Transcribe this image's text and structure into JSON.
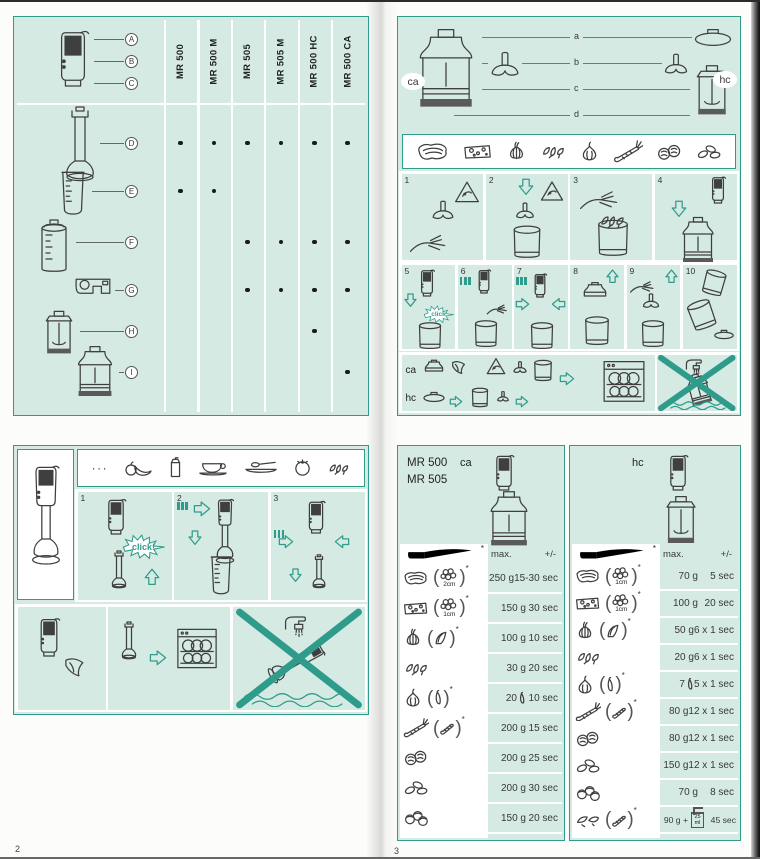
{
  "page": {
    "left_num": "2",
    "right_num": "3"
  },
  "colors": {
    "teal": "#2f9c8b",
    "mint": "#d6eae4",
    "ink": "#383838",
    "paper": "#fcfcfa"
  },
  "compat": {
    "models": [
      "MR 500",
      "MR 500 M",
      "MR 505",
      "MR 505 M",
      "MR 500 HC",
      "MR 500 CA"
    ],
    "head_parts": [
      "A",
      "B",
      "C"
    ],
    "rows": [
      {
        "part": "D",
        "icon": "shaft",
        "dots": [
          true,
          true,
          true,
          true,
          true,
          true
        ]
      },
      {
        "part": "E",
        "icon": "beaker",
        "dots": [
          true,
          true,
          false,
          false,
          false,
          false
        ]
      },
      {
        "part": "F",
        "icon": "cup",
        "dots": [
          false,
          false,
          true,
          true,
          true,
          true
        ]
      },
      {
        "part": "G",
        "icon": "bracket",
        "dots": [
          false,
          false,
          true,
          true,
          true,
          true
        ]
      },
      {
        "part": "H",
        "icon": "chopper-hc",
        "dots": [
          false,
          false,
          false,
          false,
          true,
          false
        ]
      },
      {
        "part": "I",
        "icon": "chopper-ca",
        "dots": [
          false,
          false,
          false,
          false,
          false,
          true
        ]
      }
    ]
  },
  "assembly": {
    "ca": "ca",
    "hc": "hc",
    "letters": [
      "a",
      "b",
      "c",
      "d"
    ],
    "top_steps": [
      "1",
      "2",
      "3",
      "4"
    ],
    "bottom_steps": [
      "5",
      "6",
      "7",
      "8",
      "9",
      "10"
    ],
    "click": "click",
    "foods": [
      "meat",
      "cheese",
      "onion",
      "herbs",
      "garlic",
      "carrot",
      "walnuts",
      "almonds"
    ]
  },
  "usage": {
    "ellipsis": "···",
    "foods": [
      "fruit",
      "carton",
      "cupsaucer",
      "platespoon",
      "tomato",
      "herbs"
    ],
    "steps": [
      "1",
      "2",
      "3"
    ],
    "click": "click!"
  },
  "proc": {
    "model_line1": "MR 500",
    "model_line2": "MR 505",
    "ca": "ca",
    "hc": "hc",
    "max": "max.",
    "tol": "+/-",
    "ast": "*",
    "beaker_l1": "25",
    "beaker_l2": "ml",
    "ca_rows": [
      {
        "food": "meat",
        "prep": "cubes",
        "prep_label": "2cm",
        "amount": "250 g",
        "time": "15-30 sec"
      },
      {
        "food": "cheese",
        "prep": "cubes",
        "prep_label": "1cm",
        "amount": "150 g",
        "time": "30 sec"
      },
      {
        "food": "onion",
        "prep": "quarter",
        "amount": "100 g",
        "time": "10 sec"
      },
      {
        "food": "herbs",
        "amount": "30 g",
        "time": "20 sec"
      },
      {
        "food": "garlic",
        "prep": "clove",
        "amount": "20",
        "amount_icon": "clove",
        "time": "10 sec"
      },
      {
        "food": "carrot",
        "prep": "carrot-cut",
        "amount": "200 g",
        "time": "15 sec"
      },
      {
        "food": "walnuts",
        "amount": "200 g",
        "time": "25 sec"
      },
      {
        "food": "almonds",
        "amount": "200 g",
        "time": "30 sec"
      },
      {
        "food": "hazelnuts",
        "amount": "150 g",
        "time": "20 sec"
      }
    ],
    "hc_rows": [
      {
        "food": "meat",
        "prep": "cubes",
        "prep_label": "1cm",
        "amount": "70 g",
        "time": "5 sec"
      },
      {
        "food": "cheese",
        "prep": "cubes",
        "prep_label": "1cm",
        "amount": "100 g",
        "time": "20 sec"
      },
      {
        "food": "onion",
        "prep": "quarter",
        "amount": "50 g",
        "time": "6 x 1 sec"
      },
      {
        "food": "herbs",
        "amount": "20 g",
        "time": "6 x 1 sec"
      },
      {
        "food": "garlic",
        "prep": "clove",
        "amount": "7",
        "amount_icon": "clove",
        "time": "5 x 1 sec"
      },
      {
        "food": "carrot",
        "prep": "carrot-cut",
        "amount": "80 g",
        "time": "12 x 1 sec"
      },
      {
        "food": "walnuts",
        "amount": "80 g",
        "time": "12 x 1 sec"
      },
      {
        "food": "almonds",
        "amount": "150 g",
        "time": "12 x 1 sec"
      },
      {
        "food": "hazelnuts",
        "amount": "70 g",
        "time": "8 sec"
      },
      {
        "food": "dried-fruit",
        "prep": "carrot-cut",
        "amount": "90 g +",
        "amount_icon": "beaker25",
        "time": "45 sec"
      }
    ]
  }
}
